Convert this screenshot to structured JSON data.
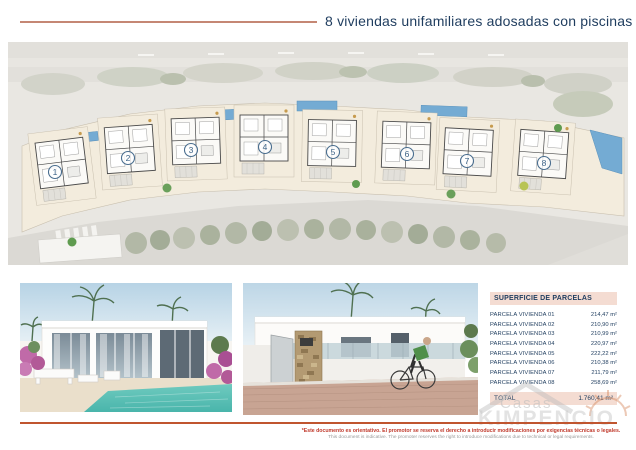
{
  "header": {
    "title": "8 viviendas unifamiliares adosadas con piscinas"
  },
  "siteplan": {
    "units": [
      {
        "number": "1"
      },
      {
        "number": "2"
      },
      {
        "number": "3"
      },
      {
        "number": "4"
      },
      {
        "number": "5"
      },
      {
        "number": "6"
      },
      {
        "number": "7"
      },
      {
        "number": "8"
      }
    ]
  },
  "parcel_table": {
    "title": "SUPERFICIE DE PARCELAS",
    "rows": [
      {
        "label": "PARCELA VIVIENDA 01",
        "value": "214,47 m²"
      },
      {
        "label": "PARCELA VIVIENDA 02",
        "value": "210,90 m²"
      },
      {
        "label": "PARCELA VIVIENDA 03",
        "value": "210,99 m²"
      },
      {
        "label": "PARCELA VIVIENDA 04",
        "value": "220,97 m²"
      },
      {
        "label": "PARCELA VIVIENDA 05",
        "value": "222,22 m²"
      },
      {
        "label": "PARCELA VIVIENDA 06",
        "value": "210,38 m²"
      },
      {
        "label": "PARCELA VIVIENDA 07",
        "value": "211,79 m²"
      },
      {
        "label": "PARCELA VIVIENDA 08",
        "value": "258,69 m²"
      }
    ],
    "total_label": "TOTAL",
    "total_value": "1.760,41 m²"
  },
  "watermark": {
    "top": "Casas",
    "bottom": "KIMPENCIO"
  },
  "footer": {
    "disclaimer_es": "*Este documento es orientativo. El promotor se reserva el derecho a introducir modificaciones por exigencias técnicas o legales.",
    "disclaimer_en": "This document is indicative. The promoter reserves the right to introduce modifications due to technical or legal requirements."
  },
  "colors": {
    "accent_salmon": "#c58774",
    "accent_red_line": "#c0552f",
    "navy_text": "#1e3c5e",
    "table_highlight_bg": "#f4dcd2",
    "pool_blue": "#74abd3",
    "plot_cream": "#f3ecdd"
  }
}
